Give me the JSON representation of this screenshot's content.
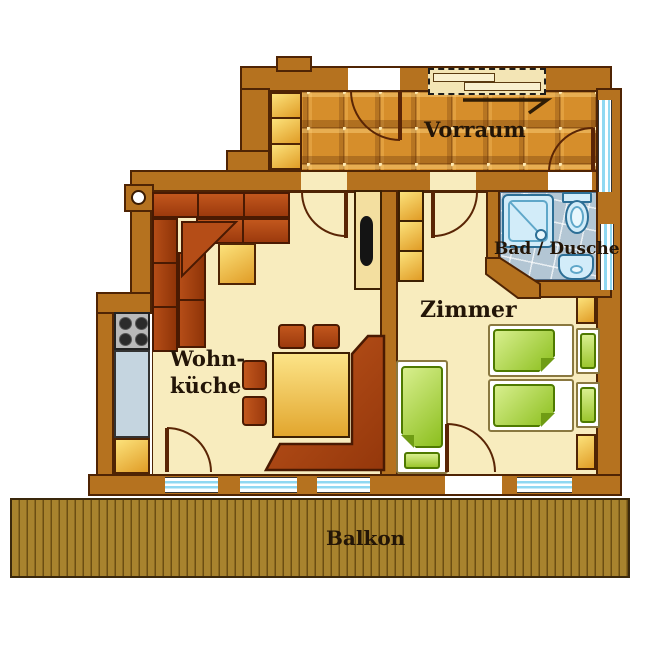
{
  "rooms": {
    "vorraum": {
      "label": "Vorraum"
    },
    "bad_dusche": {
      "label": "Bad / Dusche"
    },
    "zimmer": {
      "label": "Zimmer"
    },
    "wohnkueche": {
      "label_line1": "Wohn-",
      "label_line2": "küche"
    },
    "balkon": {
      "label": "Balkon"
    }
  },
  "theme": {
    "wall_fill": "#b5721f",
    "wall_outline": "#4f2404",
    "floor_cream": "#f8ecbe",
    "tile_orange": "#d68e2b",
    "bath_tile": "#b3c6d4",
    "fixture_blue": "#d2ecf9",
    "fixture_outline": "#2d6f96",
    "furniture_rust": "#b24312",
    "furniture_yellow_light": "#fce27b",
    "furniture_yellow_dark": "#e09c26",
    "bed_green_light": "#d8ef8e",
    "bed_green_dark": "#8cbf1e",
    "deck_wood": "#a8832e",
    "window_glass": "#8fd8f2",
    "text_color": "#231507"
  }
}
